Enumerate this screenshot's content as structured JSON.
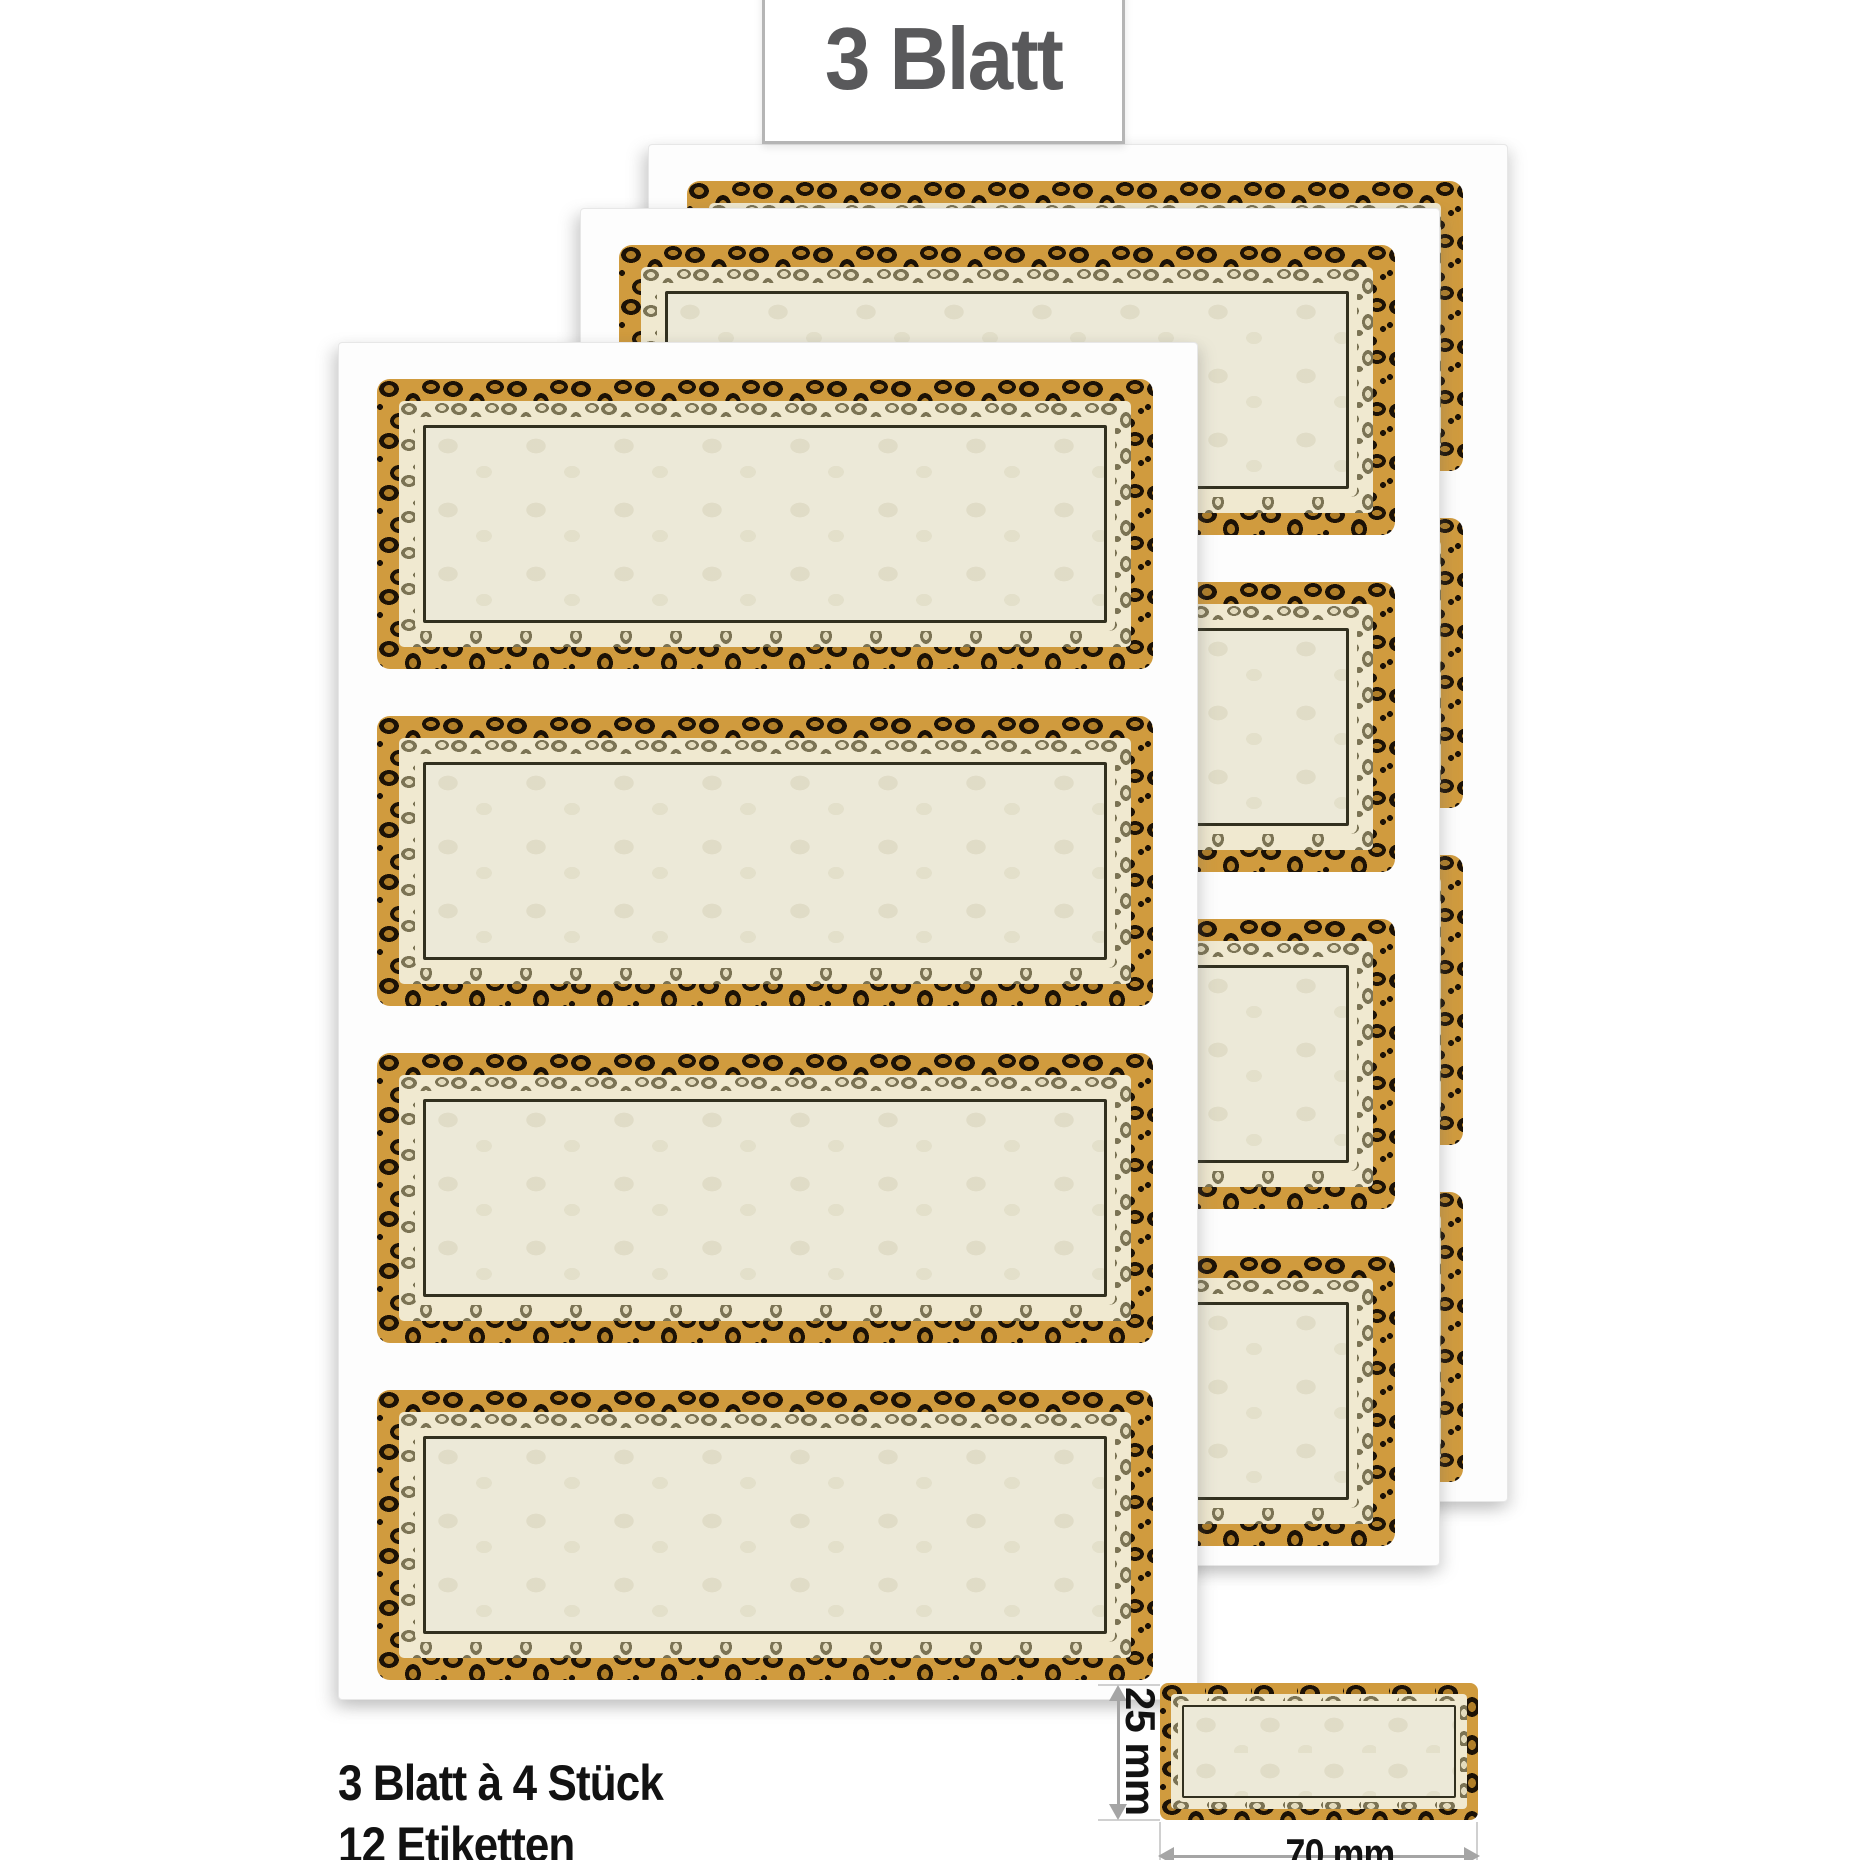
{
  "badge": {
    "label": "3 Blatt"
  },
  "summary": {
    "line1": "3 Blatt à 4 Stück",
    "line2": "12 Etiketten"
  },
  "dimension_diagram": {
    "height_label": "25 mm",
    "width_label": "70 mm"
  },
  "product_display": {
    "sheet_count": 3,
    "labels_per_sheet": 4,
    "sheets": [
      {
        "name": "back",
        "left": 648,
        "top": 144
      },
      {
        "name": "middle",
        "left": 580,
        "top": 208
      },
      {
        "name": "front",
        "left": 338,
        "top": 342
      }
    ],
    "label_layout": {
      "left": 38,
      "top_start": 36,
      "pitch": 337,
      "width": 776,
      "height": 290
    }
  },
  "colors": {
    "page_bg": "#ffffff",
    "sheet_white": "#fdfdfd",
    "leopard_tan": "#d09b3e",
    "leopard_spot": "#1c1206",
    "rosette_center": "#b07e28",
    "band_cream": "#f0e9d0",
    "band_spot": "#7b7354",
    "band_spot_center": "#e3dbbd",
    "label_cream": "#ece9d8",
    "inner_line": "#32301f",
    "badge_border": "#b5b5b5",
    "badge_text": "#59595b",
    "text_black": "#121212",
    "arrow_gray": "#a5a5a5",
    "ext_line_gray": "#d0d0d0"
  }
}
